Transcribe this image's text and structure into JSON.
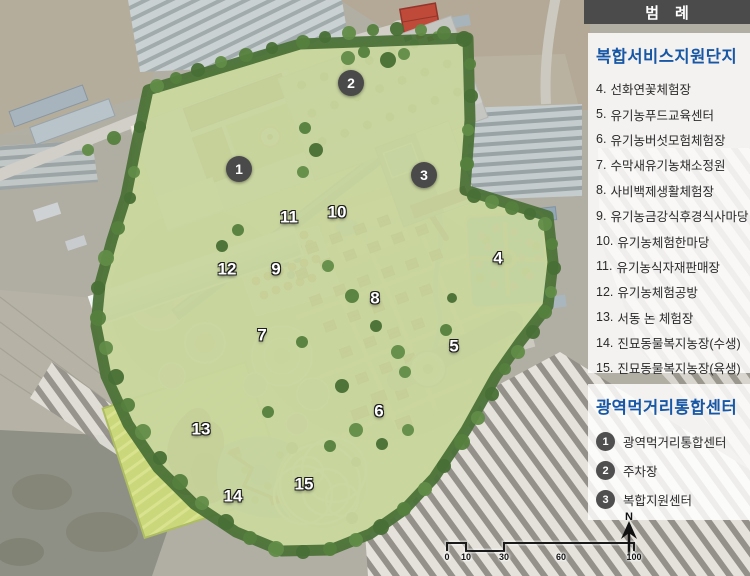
{
  "legend": {
    "title": "범례",
    "section_complex": {
      "heading": "복합서비스지원단지",
      "items": [
        {
          "num": "4",
          "label": "선화연꽃체험장"
        },
        {
          "num": "5",
          "label": "유기농푸드교육센터"
        },
        {
          "num": "6",
          "label": "유기농버섯모험체험장"
        },
        {
          "num": "7",
          "label": "수막새유기농채소정원"
        },
        {
          "num": "8",
          "label": "사비백제생활체험장"
        },
        {
          "num": "9",
          "label": "유기농금강식후경식사마당"
        },
        {
          "num": "10",
          "label": "유기농체험한마당"
        },
        {
          "num": "11",
          "label": "유기농식자재판매장"
        },
        {
          "num": "12",
          "label": "유기농체험공방"
        },
        {
          "num": "13",
          "label": "서동 논 체험장"
        },
        {
          "num": "14",
          "label": "진묘동물복지농장(수생)"
        },
        {
          "num": "15",
          "label": "진묘동물복지농장(육생)"
        }
      ]
    },
    "section_center": {
      "heading": "광역먹거리통합센터",
      "items": [
        {
          "num": "1",
          "label": "광역먹거리통합센터"
        },
        {
          "num": "2",
          "label": "주차장"
        },
        {
          "num": "3",
          "label": "복합지원센터"
        }
      ]
    }
  },
  "map": {
    "badge_markers": [
      {
        "num": "1",
        "x": 239,
        "y": 169
      },
      {
        "num": "2",
        "x": 351,
        "y": 83
      },
      {
        "num": "3",
        "x": 424,
        "y": 175
      }
    ],
    "number_markers": [
      {
        "num": "4",
        "x": 498,
        "y": 258
      },
      {
        "num": "5",
        "x": 454,
        "y": 346
      },
      {
        "num": "6",
        "x": 379,
        "y": 411
      },
      {
        "num": "7",
        "x": 262,
        "y": 335
      },
      {
        "num": "8",
        "x": 375,
        "y": 298
      },
      {
        "num": "9",
        "x": 276,
        "y": 269
      },
      {
        "num": "10",
        "x": 337,
        "y": 212
      },
      {
        "num": "11",
        "x": 289,
        "y": 217
      },
      {
        "num": "12",
        "x": 227,
        "y": 269
      },
      {
        "num": "13",
        "x": 201,
        "y": 429
      },
      {
        "num": "14",
        "x": 233,
        "y": 496
      },
      {
        "num": "15",
        "x": 304,
        "y": 484
      }
    ]
  },
  "scalebar": {
    "labels": [
      {
        "text": "0",
        "x": 447
      },
      {
        "text": "10",
        "x": 466
      },
      {
        "text": "30",
        "x": 504
      },
      {
        "text": "60",
        "x": 561
      },
      {
        "text": "100",
        "x": 634
      }
    ]
  },
  "compass": {
    "label": "N"
  },
  "colors": {
    "legend_heading": "#1757a5",
    "title_bar": "#4b4b4b",
    "legend_badge": "#4f4f4f",
    "map_badge": "#4a4a4a"
  }
}
